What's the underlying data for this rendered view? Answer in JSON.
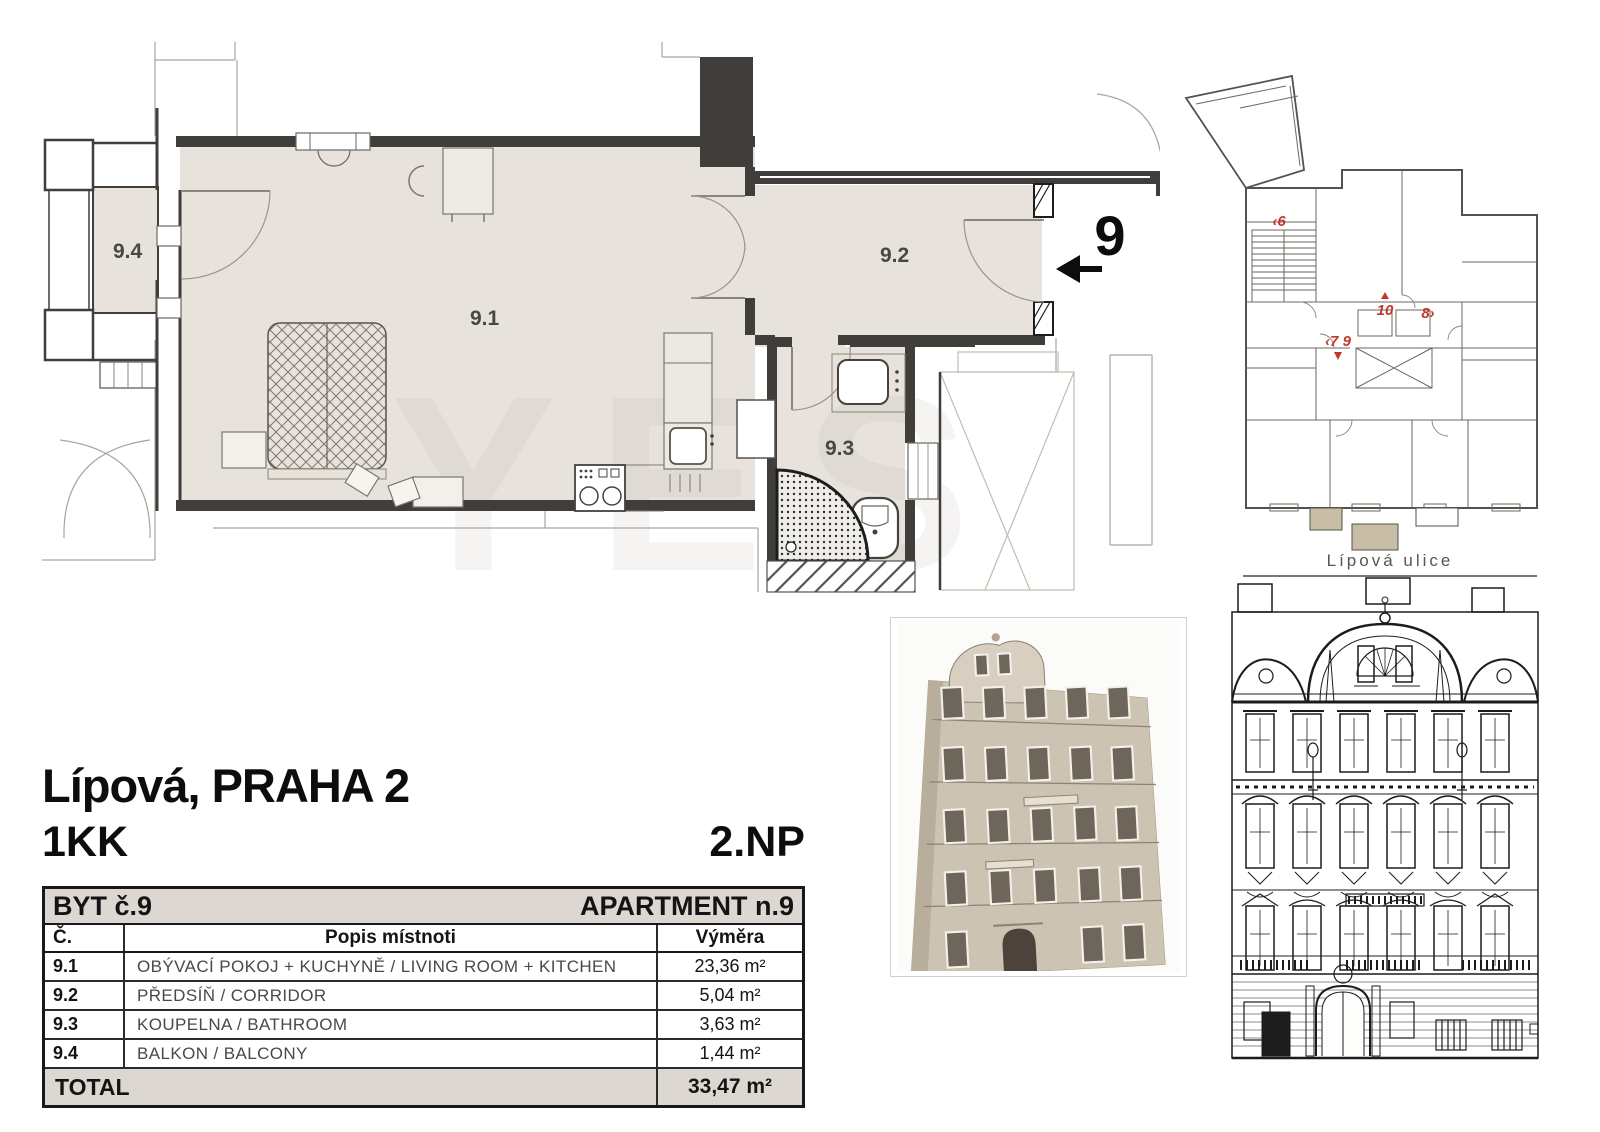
{
  "header": {
    "location": "Lípová, PRAHA 2",
    "disposition": "1KK",
    "floor": "2.NP"
  },
  "floor_plan": {
    "apartment_number": "9",
    "room_living": "9.1",
    "room_corridor": "9.2",
    "room_bathroom": "9.3",
    "room_balcony": "9.4",
    "watermark": "YES"
  },
  "site_plan": {
    "street_label": "Lípová ulice",
    "unit6": "‹6",
    "unit10": "10",
    "unit8": "8›",
    "unit79": "‹7 9"
  },
  "table": {
    "title_left": "BYT č.9",
    "title_right": "APARTMENT n.9",
    "columns": {
      "num": "Č.",
      "desc": "Popis místnoti",
      "area": "Výměra"
    },
    "rows": [
      {
        "num": "9.1",
        "desc": "OBÝVACÍ POKOJ + KUCHYNĚ / LIVING ROOM + KITCHEN",
        "area": "23,36 m²"
      },
      {
        "num": "9.2",
        "desc": "PŘEDSÍŇ / CORRIDOR",
        "area": "5,04 m²"
      },
      {
        "num": "9.3",
        "desc": "KOUPELNA / BATHROOM",
        "area": "3,63 m²"
      },
      {
        "num": "9.4",
        "desc": "BALKON / BALCONY",
        "area": "1,44 m²"
      }
    ],
    "total": {
      "label": "TOTAL",
      "area": "33,47 m²"
    }
  },
  "colors": {
    "room_fill": "#e7e3dc",
    "wall": "#3f3e3b",
    "red_label": "#c0392b",
    "table_header_bg": "#dcd8d1",
    "threshold": "#c8bda6"
  }
}
